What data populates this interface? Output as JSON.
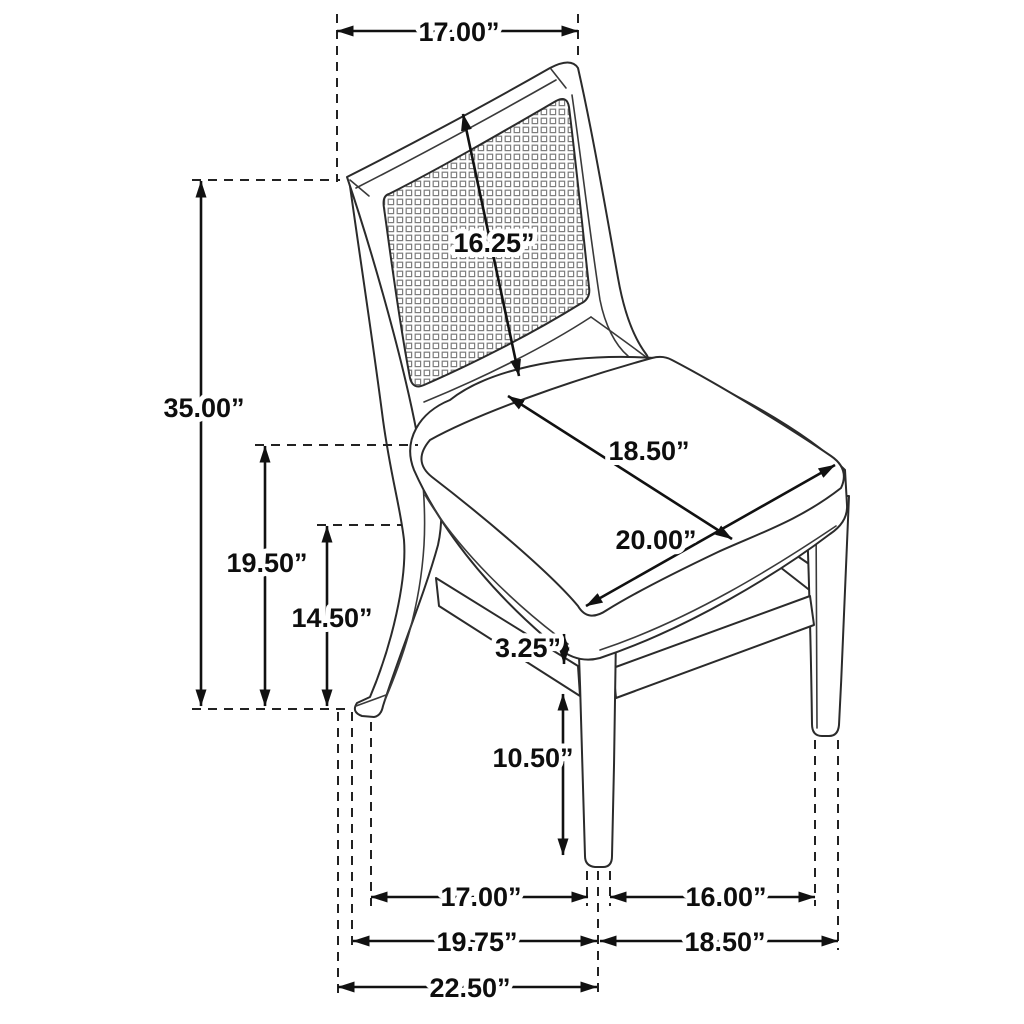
{
  "diagram": {
    "type": "furniture-dimension-diagram",
    "subject": "cane-back dining side chair with upholstered seat",
    "unit": "inches",
    "colors": {
      "line": "#2b2b2b",
      "dimension": "#111111",
      "background": "#ffffff",
      "mesh": "#7d7d7d"
    },
    "dimensions": {
      "top_back_width": "17.00”",
      "back_panel_height": "16.25”",
      "overall_height": "35.00”",
      "back_corner_height": "19.50”",
      "side_rail_height": "14.50”",
      "seat_depth": "18.50”",
      "seat_width": "20.00”",
      "rail_to_stretcher_gap": "3.25”",
      "stretcher_to_floor": "10.50”",
      "leg_spacing_side": "17.00”",
      "leg_spacing_front": "16.00”",
      "footprint_mid_depth": "19.75”",
      "footprint_front_width": "18.50”",
      "overall_depth": "22.50”"
    }
  }
}
